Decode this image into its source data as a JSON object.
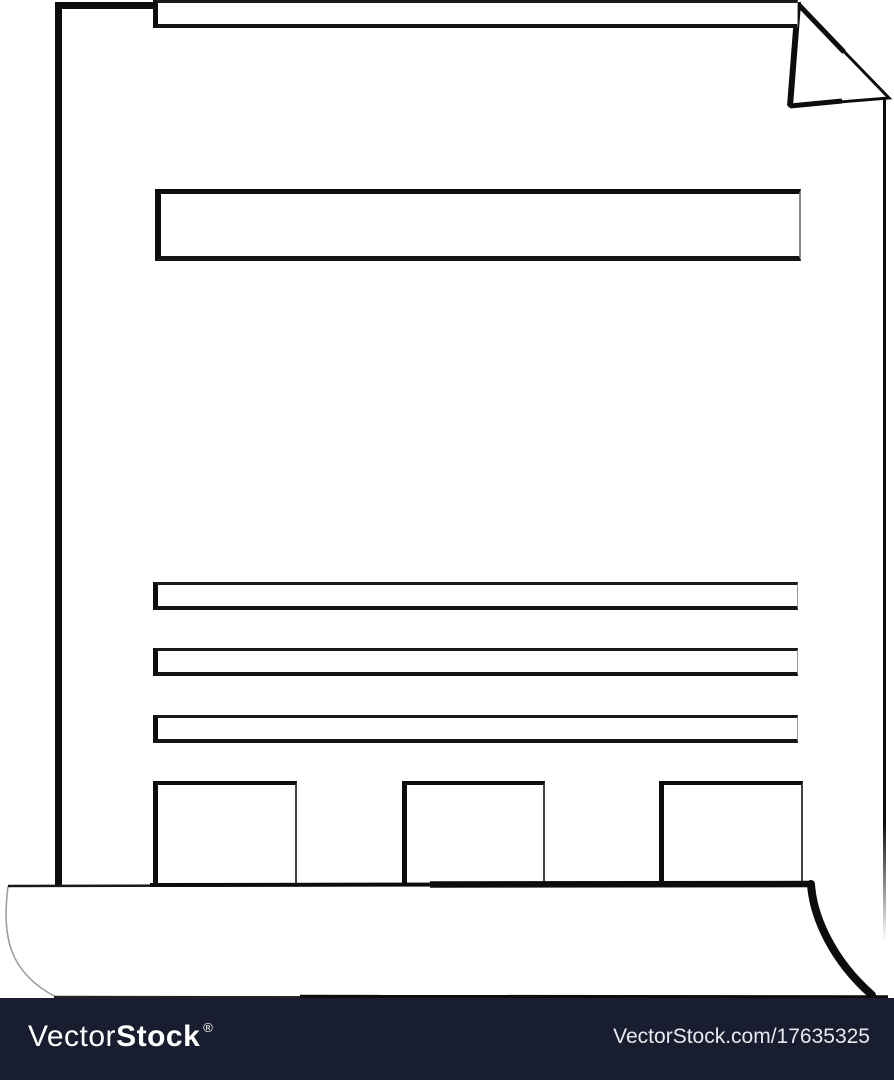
{
  "illustration": {
    "description": "sketch-style blank document sheet with folded top-right corner and curled bottom edge",
    "stroke_color": "#0d0d0d",
    "canvas_color": "#ffffff",
    "text_line_count": 7,
    "footer_block_count": 3
  },
  "watermark_bar": {
    "background_color": "#191d30",
    "logo": {
      "part_light": "Vector",
      "part_bold": "Stock",
      "registered_mark": "®",
      "color": "#ffffff"
    },
    "site_ref": {
      "text": "VectorStock.com/17635325",
      "color": "#e8e8ee"
    }
  }
}
